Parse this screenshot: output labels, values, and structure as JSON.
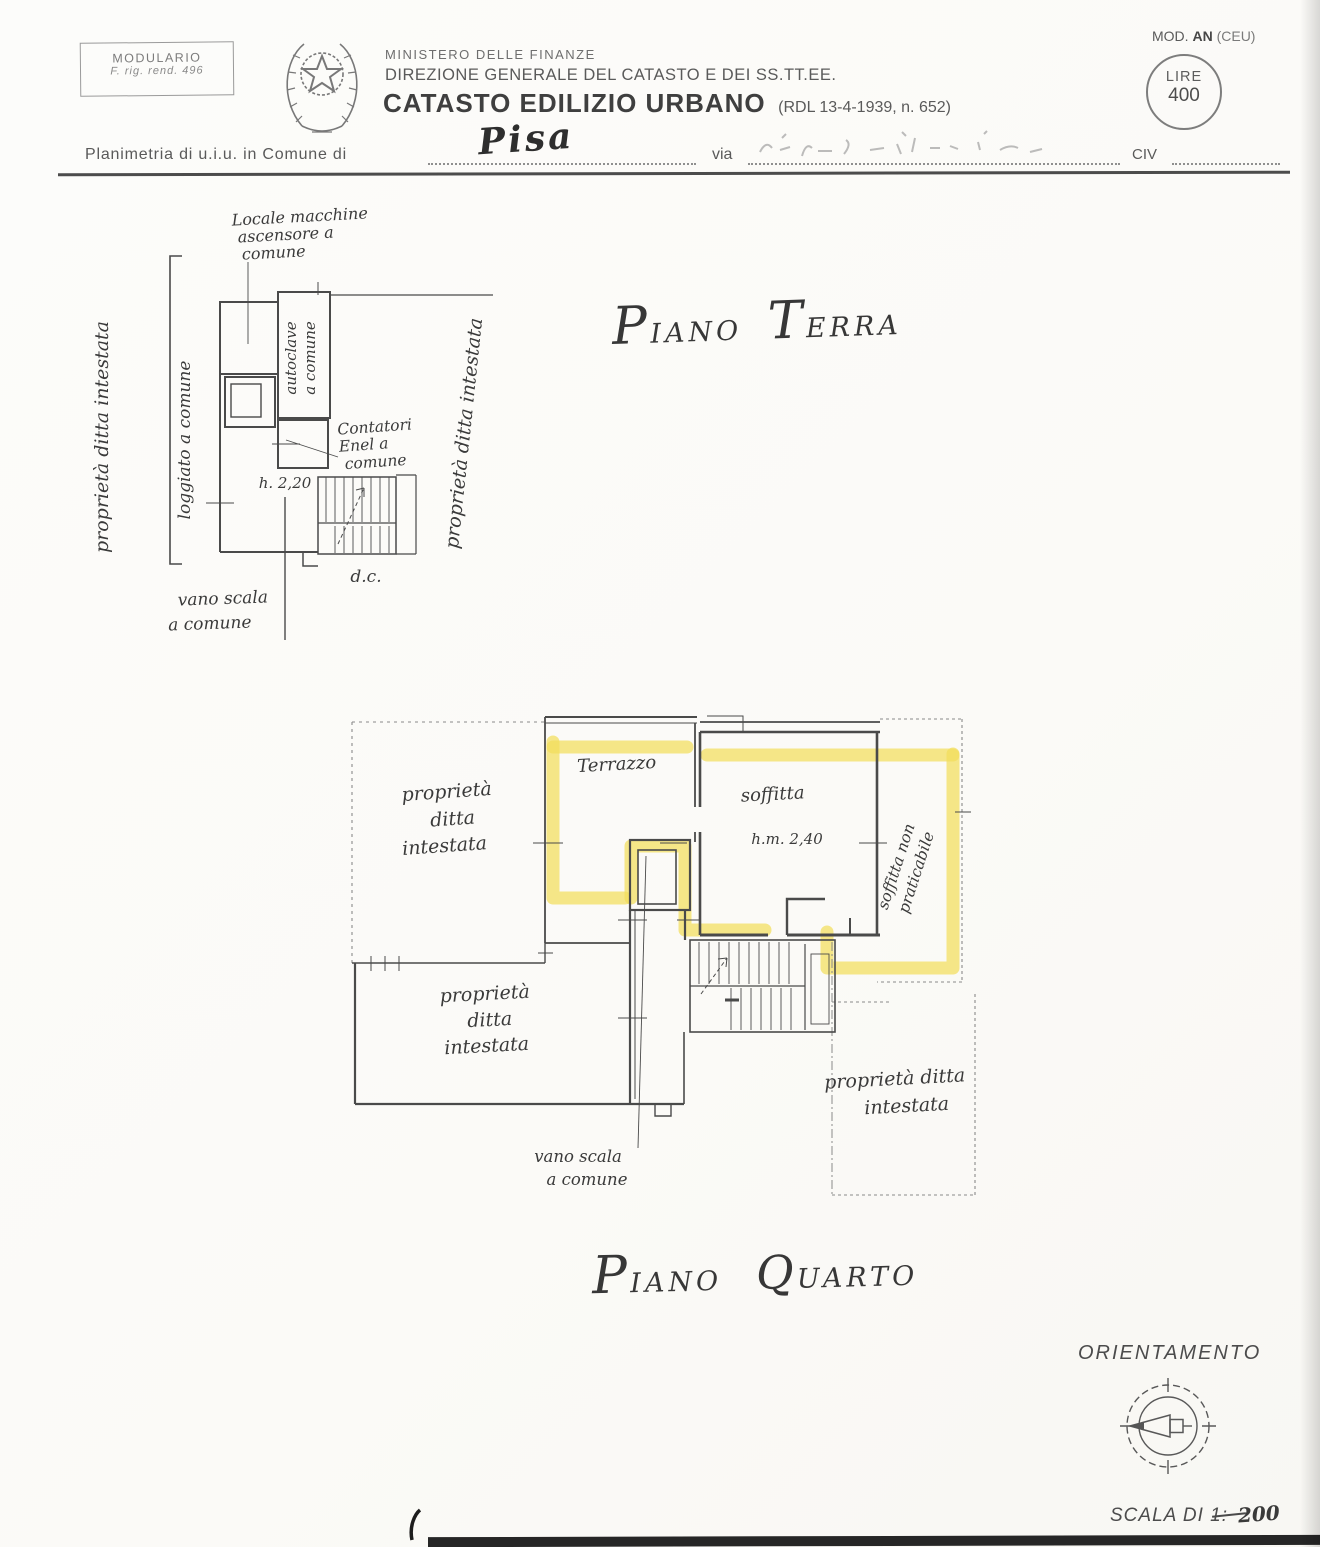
{
  "page": {
    "background": "#fbfbf8",
    "ink": "#4a4a4a",
    "hand_ink": "#3a3a3a",
    "highlight": "#f5e37b"
  },
  "header": {
    "modulario": {
      "line1": "MODULARIO",
      "line2": "F. rig. rend. 496"
    },
    "ministero": "MINISTERO DELLE FINANZE",
    "direzione": "DIREZIONE GENERALE DEL CATASTO E DEI SS.TT.EE.",
    "catasto_title": "CATASTO EDILIZIO URBANO",
    "catasto_ref": "(RDL 13-4-1939, n. 652)",
    "mod_prefix": "MOD.",
    "mod_bold": "AN",
    "mod_suffix": "(CEU)",
    "stamp_lire": "LIRE",
    "stamp_value": "400",
    "form": {
      "planimetria_label": "Planimetria di u.i.u. in Comune di",
      "comune_value": "Pisa",
      "via_label": "via",
      "civ_label": "CIV"
    }
  },
  "piano_terra": {
    "title": {
      "initial1": "P",
      "rest1": "IANO",
      "initial2": "T",
      "rest2": "ERRA"
    },
    "labels": {
      "locale_macchine": [
        "Locale macchine",
        "ascensore a",
        "comune"
      ],
      "autoclave": [
        "autoclave",
        "a comune"
      ],
      "contatori": [
        "Contatori",
        "Enel a",
        "comune"
      ],
      "altezza": "h. 2,20",
      "dc": "d.c.",
      "vano_scala": [
        "vano scala",
        "a comune"
      ],
      "prop_sx": "proprietà ditta intestata",
      "loggiato": "loggiato a comune",
      "prop_dx": "proprietà ditta intestata"
    }
  },
  "piano_quarto": {
    "title": {
      "initial1": "P",
      "rest1": "IANO",
      "initial2": "Q",
      "rest2": "UARTO"
    },
    "labels": {
      "prop_alto_sx": [
        "proprietà",
        "ditta",
        "intestata"
      ],
      "terrazzo": "Terrazzo",
      "soffitta": "soffitta",
      "soffitta_h": "h.m. 2,40",
      "soffitta_non_prat": [
        "soffitta non",
        "praticabile"
      ],
      "prop_basso_sx": [
        "proprietà",
        "ditta",
        "intestata"
      ],
      "prop_basso_dx": [
        "proprietà ditta",
        "intestata"
      ],
      "vano_scala": [
        "vano scala",
        "a comune"
      ]
    }
  },
  "footer": {
    "orientamento": "ORIENTAMENTO",
    "scala_label": "SCALA DI 1:",
    "scala_value": "200"
  }
}
